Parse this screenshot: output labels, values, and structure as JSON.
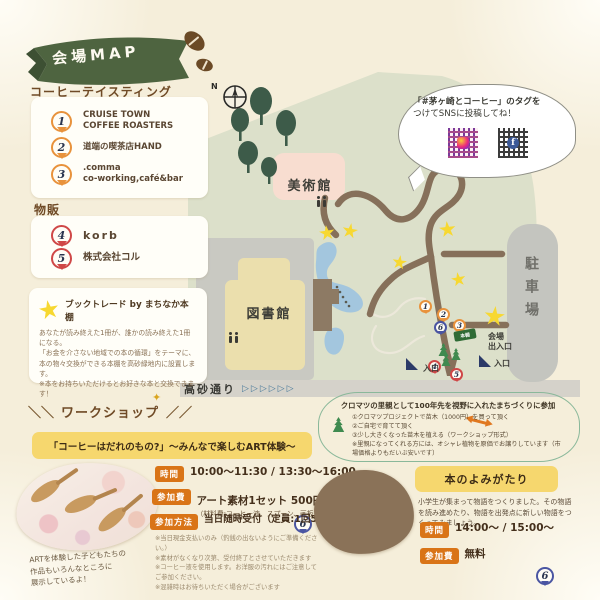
{
  "ribbon": {
    "title": "会場MAP"
  },
  "coffee_tasting": {
    "heading": "コーヒーテイスティング",
    "items": [
      {
        "num": "1",
        "label": "CRUISE TOWN\nCOFFEE ROASTERS"
      },
      {
        "num": "2",
        "label": "道端の喫茶店HAND"
      },
      {
        "num": "3",
        "label": ".comma\nco-working,café&bar"
      }
    ]
  },
  "goods": {
    "heading": "物販",
    "items": [
      {
        "num": "4",
        "label": "korb"
      },
      {
        "num": "5",
        "label": "株式会社コル"
      }
    ]
  },
  "book_trade": {
    "title": "ブックトレード by まちなか本棚",
    "body": "あなたが読み終えた1冊が、誰かの読み終えた1冊になる。\n「お金を介さない地域での本の循環」をテーマに、本の物々交換ができる本棚を高砂緑地内に設置します。\n※本をお持ちいただけるとお好きな本と交換できます！"
  },
  "sns_bubble": {
    "line1": "「#茅ヶ崎とコーヒー」のタグを",
    "line2": "つけてSNSに投稿してね！",
    "fb_glyph": "f"
  },
  "map": {
    "north": "N",
    "museum": "美術館",
    "library": "図書館",
    "parking": "駐車場",
    "street": "高砂通り",
    "street_arrows": "▷▷▷▷▷▷",
    "gate": "会場\n出入口",
    "entrance_left": "入口",
    "entrance_right": "入口",
    "sign": "本棚",
    "pins": [
      "1",
      "2",
      "3",
      "4",
      "5",
      "6"
    ]
  },
  "kuromatsu": {
    "title": "クロマツの里親として100年先を視野に入れたまちづくりに参加",
    "body": "①クロマツプロジェクトで苗木（1000円）を買って頂く\n②ご自宅で育てて頂く\n③少し大きくなった苗木を植える（ワークショップ形式）\n※里親になってくれる方には、オシャレ植物を原価でお譲りしています（市場価格よりもだいぶ安いです）"
  },
  "workshop": {
    "deco_left": "＼＼",
    "deco_right": "／／",
    "sparkle": "✦",
    "heading": "ワークショップ",
    "banner": "「コーヒーはだれのもの?」〜みんなで楽しむART体験〜",
    "banner_pin": "6",
    "rows": [
      {
        "tag": "時間",
        "value": "10:00〜11:30 / 13:30〜16:00",
        "sub": ""
      },
      {
        "tag": "参加費",
        "value": "アート素材1セット 500円",
        "sub": "（材料費:コーヒー液、スプーン、画板）"
      },
      {
        "tag": "参加方法",
        "value": "当日随時受付（定員:1回5組程度）",
        "sub": ""
      }
    ],
    "notes": "※当日現金支払いのみ（釣銭の出ないようにご準備ください。）\n※素材がなくなり次第、受付終了とさせていただきます\n※コーヒー液を使用します。お洋服の汚れにはご注意してご参加ください。\n※混雑時はお待ちいただく場合がございます",
    "photo_note": "ARTを体験した子どもたちの\n作品もいろんなところに\n展示しているよ！"
  },
  "reading": {
    "title": "本のよみがたり",
    "pin": "6",
    "body": "小学生が集まって物語をつくりました。その物語を読み進めたり、物語を出発点に新しい物語をつくってみましょう。",
    "rows": [
      {
        "tag": "時間",
        "value": "14:00〜 / 15:00〜"
      },
      {
        "tag": "参加費",
        "value": "無料"
      }
    ]
  },
  "colors": {
    "accent_orange": "#d97417",
    "banner_yellow": "#f6d76e",
    "ribbon_green": "#4e6440",
    "pin_orange": "#e8923c",
    "pin_red": "#cf4747",
    "pin_blue": "#4a55a2",
    "star_yellow": "#f7d831",
    "road_brown": "#86705a",
    "park_green": "#dce0ca",
    "page_cream": "#f5eeda"
  }
}
